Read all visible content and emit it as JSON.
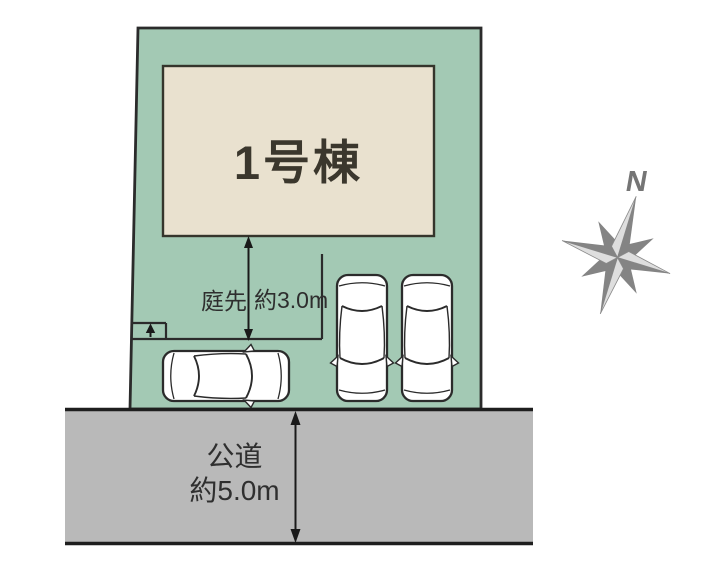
{
  "site_plan": {
    "building": {
      "label": "1号棟"
    },
    "garden": {
      "label": "庭先",
      "value": "約3.0m"
    },
    "road": {
      "label": "公道",
      "value": "約5.0m"
    },
    "compass": {
      "north_label": "N"
    },
    "colors": {
      "lot_fill": "#a3c9b4",
      "building_fill": "#e9e1cf",
      "road_fill": "#b9b9b9",
      "line_dark": "#2b2b2b",
      "compass_gray": "#8a8a8a",
      "car_fill": "#ffffff"
    },
    "icons": {
      "compass": "compass-rose-icon",
      "entrance": "up-arrow-icon",
      "vehicles": [
        "car-top-view-icon",
        "car-top-view-icon",
        "car-top-view-icon"
      ]
    }
  }
}
